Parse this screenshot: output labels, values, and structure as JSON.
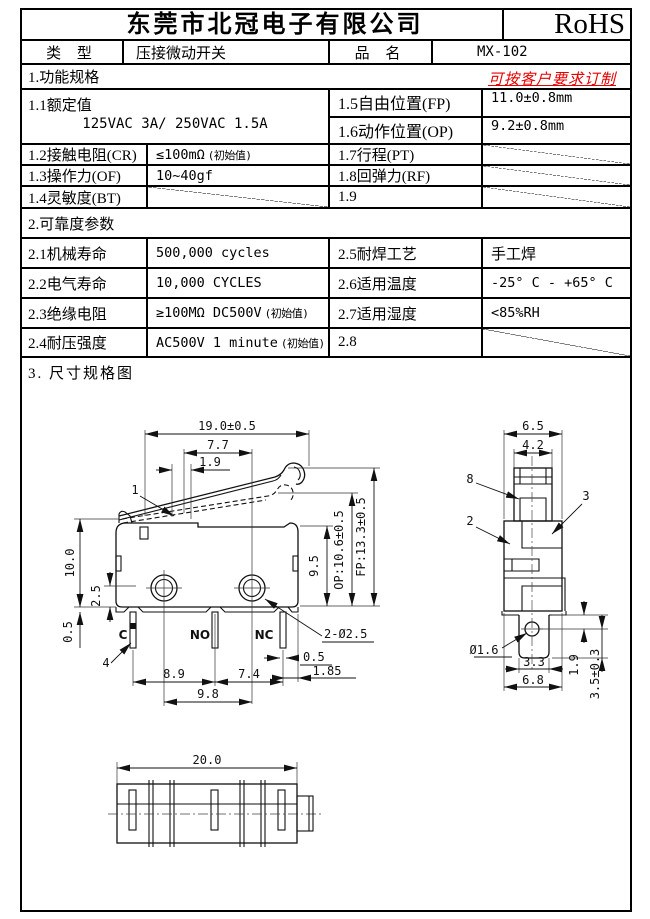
{
  "header": {
    "company": "东莞市北冠电子有限公司",
    "cert": "RoHS"
  },
  "type_row": {
    "type_label": "类 型",
    "type_value": "压接微动开关",
    "name_label": "品 名",
    "name_value": "MX-102"
  },
  "spec": {
    "title": "1.功能规格",
    "note": "可按客户要求订制",
    "rated_label": "1.1额定值",
    "rated_value": "125VAC 3A/ 250VAC 1.5A",
    "fp_label": "1.5自由位置(FP)",
    "fp_value": "11.0±0.8mm",
    "op_label": "1.6动作位置(OP)",
    "op_value": "9.2±0.8mm",
    "cr_label": "1.2接触电阻(CR)",
    "cr_value": "≤100mΩ",
    "cr_note": "(初始值)",
    "pt_label": "1.7行程(PT)",
    "of_label": "1.3操作力(OF)",
    "of_value": "10~40gf",
    "rf_label": "1.8回弹力(RF)",
    "bt_label": "1.4灵敏度(BT)",
    "r19_label": "1.9"
  },
  "reliability": {
    "title": "2.可靠度参数",
    "mech_label": "2.1机械寿命",
    "mech_value": "500,000 cycles",
    "solder_label": "2.5耐焊工艺",
    "solder_value": "手工焊",
    "elec_label": "2.2电气寿命",
    "elec_value": "10,000  CYCLES",
    "temp_label": "2.6适用温度",
    "temp_value": "-25° C - +65° C",
    "ins_label": "2.3绝缘电阻",
    "ins_value": "≥100MΩ DC500V",
    "ins_note": "(初始值)",
    "hum_label": "2.7适用湿度",
    "hum_value": "<85%RH",
    "wv_label": "2.4耐压强度",
    "wv_value": "AC500V 1 minute",
    "wv_note": "(初始值)",
    "r28_label": "2.8"
  },
  "dims_section_title": "3. 尺寸规格图",
  "drawing": {
    "front": {
      "total_width": "19.0±0.5",
      "lever_len": "7.7",
      "lever_offset": "1.9",
      "part_1": "1",
      "body_height": "10.0",
      "hole_offset": "2.5",
      "base_thickness": "0.5",
      "inner_height": "9.5",
      "op_height": "OP:10.6±0.5",
      "fp_height": "FP:13.3±0.5",
      "mount_holes": "2-Ø2.5",
      "terminal_common": "C",
      "terminal_no": "NO",
      "terminal_nc": "NC",
      "part_4": "4",
      "terminal_thickness": "0.5",
      "nc_edge_offset": "1.85",
      "pitch_c_no": "8.9",
      "pitch_no_nc": "7.4",
      "hole_pitch": "9.8"
    },
    "side": {
      "body_width": "6.5",
      "button_width": "4.2",
      "part_8": "8",
      "part_3": "3",
      "part_2": "2",
      "hole_diameter": "Ø1.6",
      "tab_width": "3.3",
      "base_width": "6.8",
      "hole_height": "1.9",
      "tab_height": "3.5±0.3"
    },
    "bottom": {
      "total_length": "20.0"
    }
  },
  "colors": {
    "accent_red": "#e60000",
    "line": "#000000"
  }
}
